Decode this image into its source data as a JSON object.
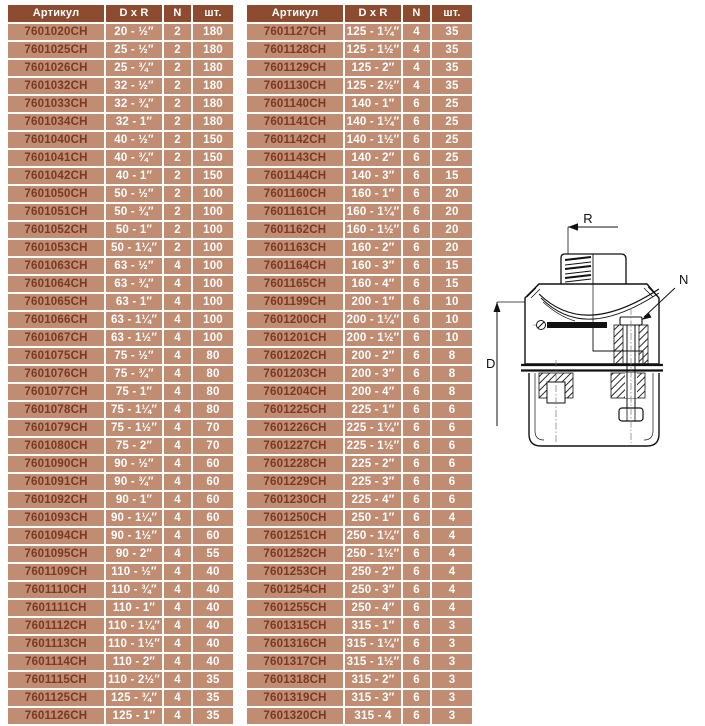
{
  "colors": {
    "page_bg": "#ffffff",
    "header_bg": "#8D4C30",
    "cell_bg": "#C08C72",
    "article_text": "#7A3922",
    "cell_text": "#FFFFFF",
    "line": "#1a1a1a"
  },
  "tables": [
    {
      "headers": [
        "Артикул",
        "D x R",
        "N",
        "шт."
      ],
      "rows": [
        [
          "7601020CH",
          "20 - ½″",
          "2",
          "180"
        ],
        [
          "7601025CH",
          "25 - ½″",
          "2",
          "180"
        ],
        [
          "7601026CH",
          "25 - ¾″",
          "2",
          "180"
        ],
        [
          "7601032CH",
          "32 - ½″",
          "2",
          "180"
        ],
        [
          "7601033CH",
          "32 - ¾″",
          "2",
          "180"
        ],
        [
          "7601034CH",
          "32 - 1″",
          "2",
          "180"
        ],
        [
          "7601040CH",
          "40 - ½″",
          "2",
          "150"
        ],
        [
          "7601041CH",
          "40 - ¾″",
          "2",
          "150"
        ],
        [
          "7601042CH",
          "40 - 1″",
          "2",
          "150"
        ],
        [
          "7601050CH",
          "50 - ½″",
          "2",
          "100"
        ],
        [
          "7601051CH",
          "50 - ¾″",
          "2",
          "100"
        ],
        [
          "7601052CH",
          "50 - 1″",
          "2",
          "100"
        ],
        [
          "7601053CH",
          "50 - 1¼″",
          "2",
          "100"
        ],
        [
          "7601063CH",
          "63 - ½″",
          "4",
          "100"
        ],
        [
          "7601064CH",
          "63 - ¾″",
          "4",
          "100"
        ],
        [
          "7601065CH",
          "63 - 1″",
          "4",
          "100"
        ],
        [
          "7601066CH",
          "63 - 1¼″",
          "4",
          "100"
        ],
        [
          "7601067CH",
          "63 - 1½″",
          "4",
          "100"
        ],
        [
          "7601075CH",
          "75 - ½″",
          "4",
          "80"
        ],
        [
          "7601076CH",
          "75 - ¾″",
          "4",
          "80"
        ],
        [
          "7601077CH",
          "75 - 1″",
          "4",
          "80"
        ],
        [
          "7601078CH",
          "75 - 1¼″",
          "4",
          "80"
        ],
        [
          "7601079CH",
          "75 - 1½″",
          "4",
          "70"
        ],
        [
          "7601080CH",
          "75 - 2″",
          "4",
          "70"
        ],
        [
          "7601090CH",
          "90 - ½″",
          "4",
          "60"
        ],
        [
          "7601091CH",
          "90 - ¾″",
          "4",
          "60"
        ],
        [
          "7601092CH",
          "90 - 1″",
          "4",
          "60"
        ],
        [
          "7601093CH",
          "90 - 1¼″",
          "4",
          "60"
        ],
        [
          "7601094CH",
          "90 - 1½″",
          "4",
          "60"
        ],
        [
          "7601095CH",
          "90 - 2″",
          "4",
          "55"
        ],
        [
          "7601109CH",
          "110 - ½″",
          "4",
          "40"
        ],
        [
          "7601110CH",
          "110 - ¾″",
          "4",
          "40"
        ],
        [
          "7601111CH",
          "110 - 1″",
          "4",
          "40"
        ],
        [
          "7601112CH",
          "110 - 1¼″",
          "4",
          "40"
        ],
        [
          "7601113CH",
          "110 - 1½″",
          "4",
          "40"
        ],
        [
          "7601114CH",
          "110 - 2″",
          "4",
          "40"
        ],
        [
          "7601115CH",
          "110 - 2½″",
          "4",
          "35"
        ],
        [
          "7601125CH",
          "125 - ¾″",
          "4",
          "35"
        ],
        [
          "7601126CH",
          "125 - 1″",
          "4",
          "35"
        ]
      ]
    },
    {
      "headers": [
        "Артикул",
        "D x R",
        "N",
        "шт."
      ],
      "rows": [
        [
          "7601127CH",
          "125 - 1¼″",
          "4",
          "35"
        ],
        [
          "7601128CH",
          "125 - 1½″",
          "4",
          "35"
        ],
        [
          "7601129CH",
          "125 - 2″",
          "4",
          "35"
        ],
        [
          "7601130CH",
          "125 - 2½″",
          "4",
          "35"
        ],
        [
          "7601140CH",
          "140 - 1″",
          "6",
          "25"
        ],
        [
          "7601141CH",
          "140 - 1¼″",
          "6",
          "25"
        ],
        [
          "7601142CH",
          "140 - 1½″",
          "6",
          "25"
        ],
        [
          "7601143CH",
          "140 - 2″",
          "6",
          "25"
        ],
        [
          "7601144CH",
          "140 - 3″",
          "6",
          "15"
        ],
        [
          "7601160CH",
          "160 - 1″",
          "6",
          "20"
        ],
        [
          "7601161CH",
          "160 - 1¼″",
          "6",
          "20"
        ],
        [
          "7601162CH",
          "160 - 1½″",
          "6",
          "20"
        ],
        [
          "7601163CH",
          "160 - 2″",
          "6",
          "20"
        ],
        [
          "7601164CH",
          "160 - 3″",
          "6",
          "15"
        ],
        [
          "7601165CH",
          "160 - 4″",
          "6",
          "15"
        ],
        [
          "7601199CH",
          "200 - 1″",
          "6",
          "10"
        ],
        [
          "7601200CH",
          "200 - 1¼″",
          "6",
          "10"
        ],
        [
          "7601201CH",
          "200 - 1½″",
          "6",
          "10"
        ],
        [
          "7601202CH",
          "200 - 2″",
          "6",
          "8"
        ],
        [
          "7601203CH",
          "200 - 3″",
          "6",
          "8"
        ],
        [
          "7601204CH",
          "200 - 4″",
          "6",
          "8"
        ],
        [
          "7601225CH",
          "225 - 1″",
          "6",
          "6"
        ],
        [
          "7601226CH",
          "225 - 1¼″",
          "6",
          "6"
        ],
        [
          "7601227CH",
          "225 - 1½″",
          "6",
          "6"
        ],
        [
          "7601228CH",
          "225 - 2″",
          "6",
          "6"
        ],
        [
          "7601229CH",
          "225 - 3″",
          "6",
          "6"
        ],
        [
          "7601230CH",
          "225 - 4″",
          "6",
          "6"
        ],
        [
          "7601250CH",
          "250 - 1″",
          "6",
          "4"
        ],
        [
          "7601251CH",
          "250 - 1¼″",
          "6",
          "4"
        ],
        [
          "7601252CH",
          "250 - 1½″",
          "6",
          "4"
        ],
        [
          "7601253CH",
          "250 - 2″",
          "6",
          "4"
        ],
        [
          "7601254CH",
          "250 - 3″",
          "6",
          "4"
        ],
        [
          "7601255CH",
          "250 - 4″",
          "6",
          "4"
        ],
        [
          "7601315CH",
          "315 - 1″",
          "6",
          "3"
        ],
        [
          "7601316CH",
          "315 - 1¼″",
          "6",
          "3"
        ],
        [
          "7601317CH",
          "315 - 1½″",
          "6",
          "3"
        ],
        [
          "7601318CH",
          "315 - 2″",
          "6",
          "3"
        ],
        [
          "7601319CH",
          "315 - 3″",
          "6",
          "3"
        ],
        [
          "7601320CH",
          "315 - 4",
          "6",
          "3"
        ]
      ]
    }
  ],
  "diagram": {
    "labels": {
      "r": "R",
      "n": "N",
      "d": "D"
    }
  }
}
